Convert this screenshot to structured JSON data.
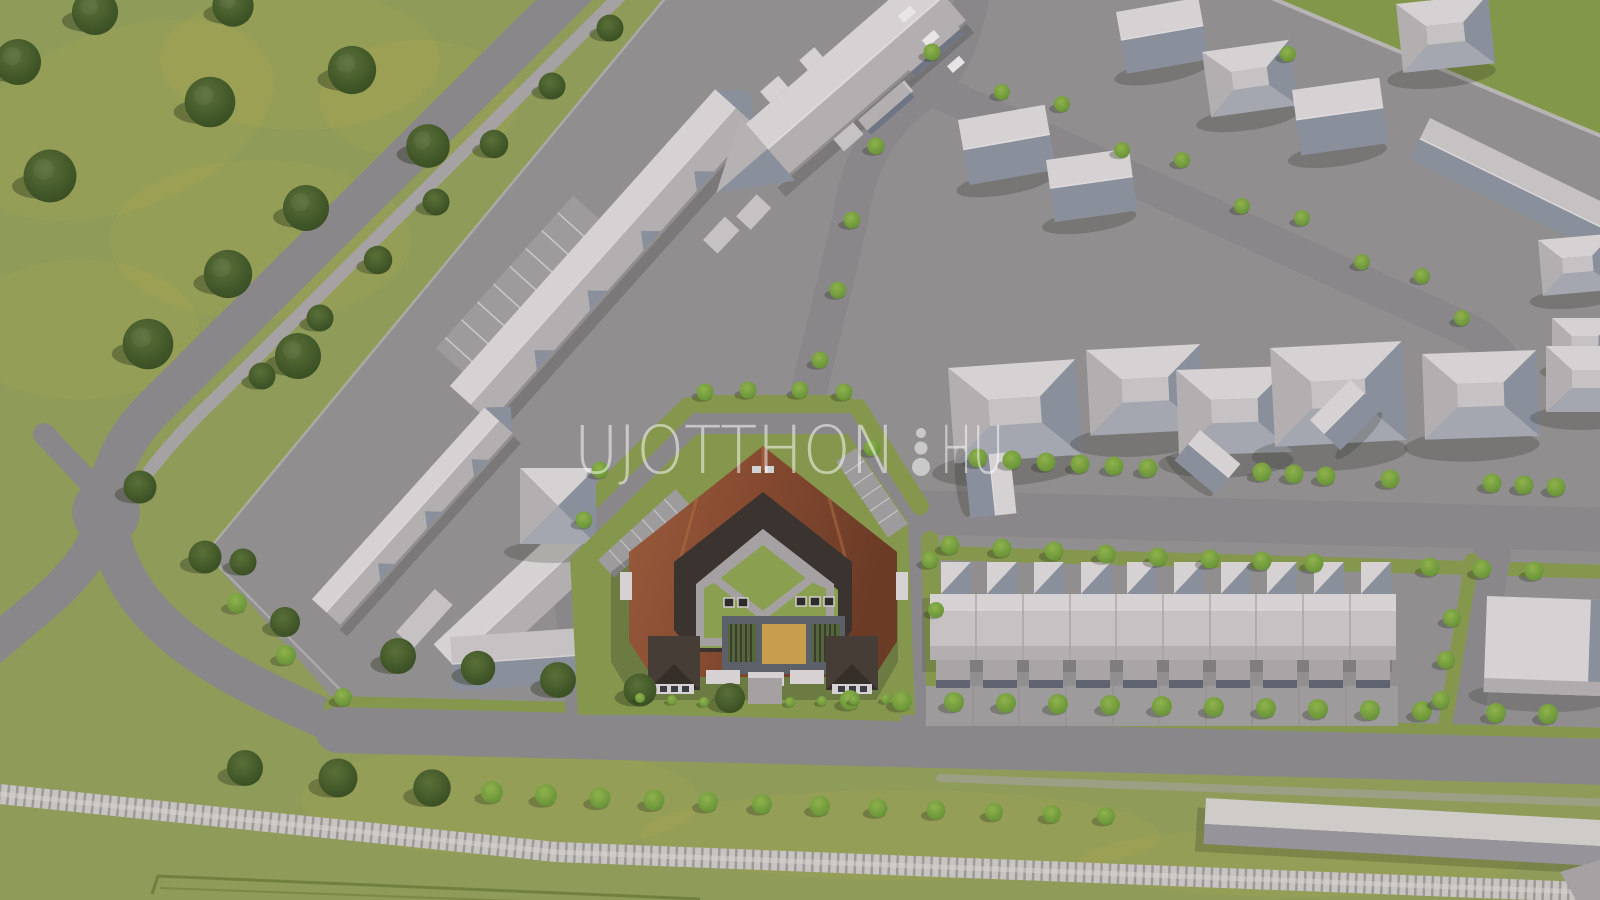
{
  "watermark": {
    "main": "UJOTTHON",
    "suffix": "HU",
    "separator_icon": "three-dots-logo",
    "color": "#ffffff"
  },
  "scene": {
    "type": "3d-aerial-site-plan-render",
    "elements": {
      "central_building": "pentagon-courtyard-apartment-block",
      "courtyard": "lawn-diamond-walkway-playground",
      "row_houses": "terraced-houses-with-garages",
      "railway": "railway-track",
      "left_field": "green-field-with-trees",
      "neighborhood": "detached-houses-top-right",
      "public_complex": "l-shaped-building-left",
      "warehouse": "long-flat-building-bottom-right"
    }
  },
  "colors": {
    "grass": "#8f9b58",
    "lawn": "#85974d",
    "lawn2": "#8aa050",
    "pav": "#918e90",
    "pavLight": "#9e9b9d",
    "road": "#8a878a",
    "sidewalk": "#a6a2a4",
    "curb": "#c2bec0",
    "roofLight": "#c6c2c3",
    "roofWhite": "#d6d2d3",
    "roofMid": "#b3afb1",
    "roofShade": "#8a8f9c",
    "roofSouth": "#a4a7b0",
    "wallDark": "#6f7585",
    "brown1": "#9a5c3d",
    "brown2": "#84492f",
    "brown3": "#6e3d28",
    "innerDark": "#3a332f",
    "terrace": "#5b6069",
    "gableDark": "#463d37",
    "sand": "#c79f4c",
    "path": "#a5a1a3",
    "rail": "#c8c4c1",
    "tie": "#8f8b88"
  }
}
